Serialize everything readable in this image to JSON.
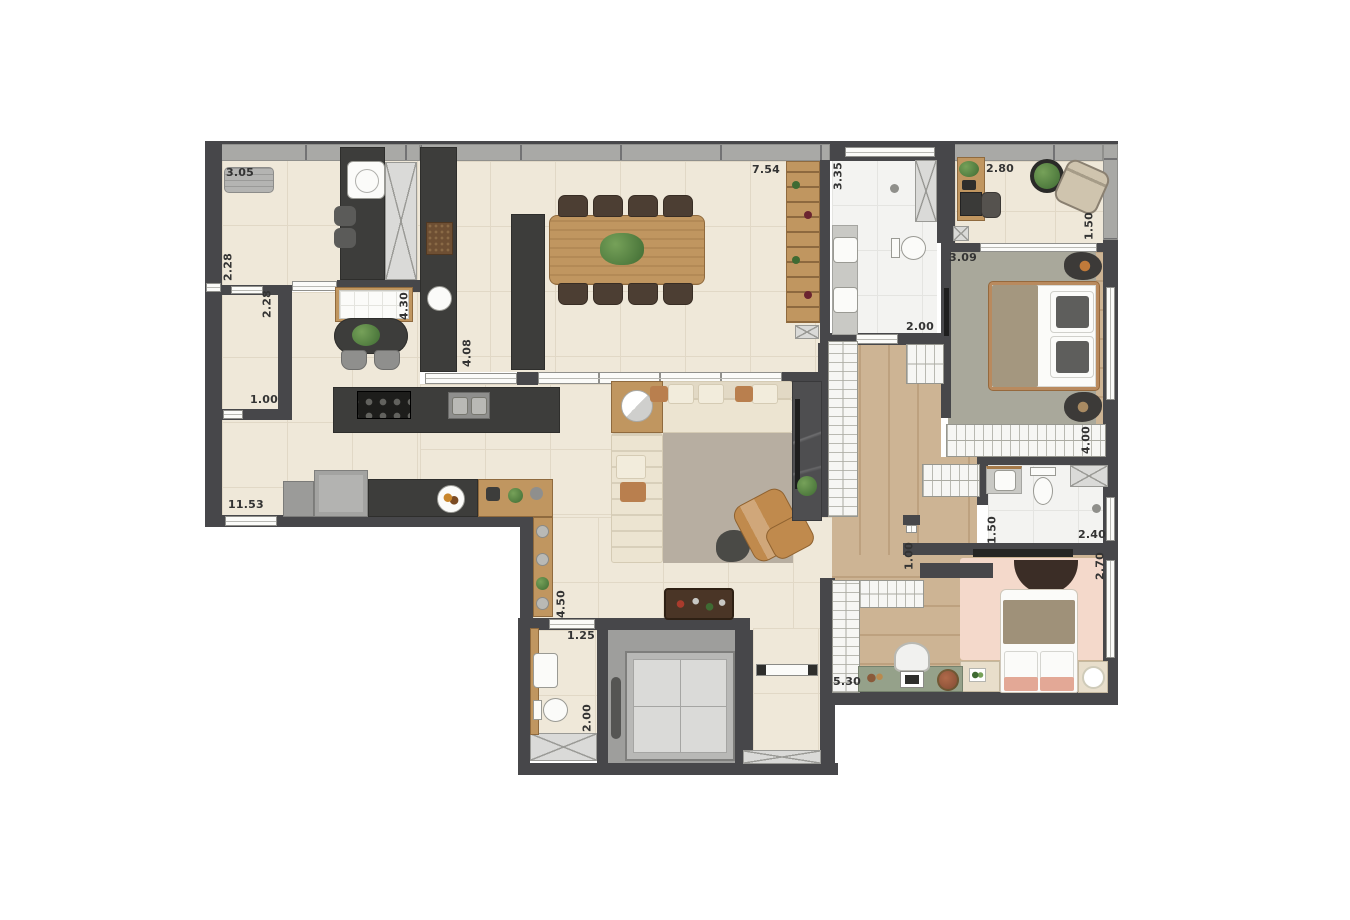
{
  "labels": {
    "service_width": "3.05",
    "service_depth": "2.28",
    "wc_service_depth": "2.28",
    "wc_service_width": "1.00",
    "plan_width": "11.53",
    "nook_length": "4.30",
    "kitchen_length": "4.08",
    "living_width": "7.54",
    "master_bath_length": "3.35",
    "master_bath_width": "2.00",
    "balcony_width": "2.80",
    "balcony_depth": "1.50",
    "master_bed_width": "3.09",
    "closet_length": "4.00",
    "bath2_depth": "1.50",
    "bath2_width": "2.40",
    "hall_door_width": "1.00",
    "bed2_depth": "2.70",
    "pantry_length": "4.50",
    "lavabo_width": "1.25",
    "lavabo_depth": "2.00",
    "closet2_length": "5.30"
  },
  "colors": {
    "wall": "#47474a",
    "facade": "#a9a9a6",
    "tile_floor": "#efe8d9",
    "tile_line": "#e1d8c6",
    "marble_floor": "#f3f3f1",
    "marble_line": "#e4e4e1",
    "wood_floor": "#cdb494",
    "wood_line": "#bda17f",
    "counter": "#3d3d3b",
    "wood_furniture": "#c09660",
    "chair_dark": "#4c3e33",
    "sofa": "#ece4d1",
    "rug_living": "#b7aea1",
    "rug_master": "#a9a89b",
    "rug_pink": "#f4d9cb",
    "armchair_tan": "#c08a4d",
    "desk_green": "#95a18a",
    "wardrobe": "#f6f6f4",
    "shaft": "#dadad8",
    "fixture": "#fbfbf9",
    "elevator_outer": "#9e9e9c",
    "elevator_cab": "#dadad8",
    "label": "#333333"
  }
}
